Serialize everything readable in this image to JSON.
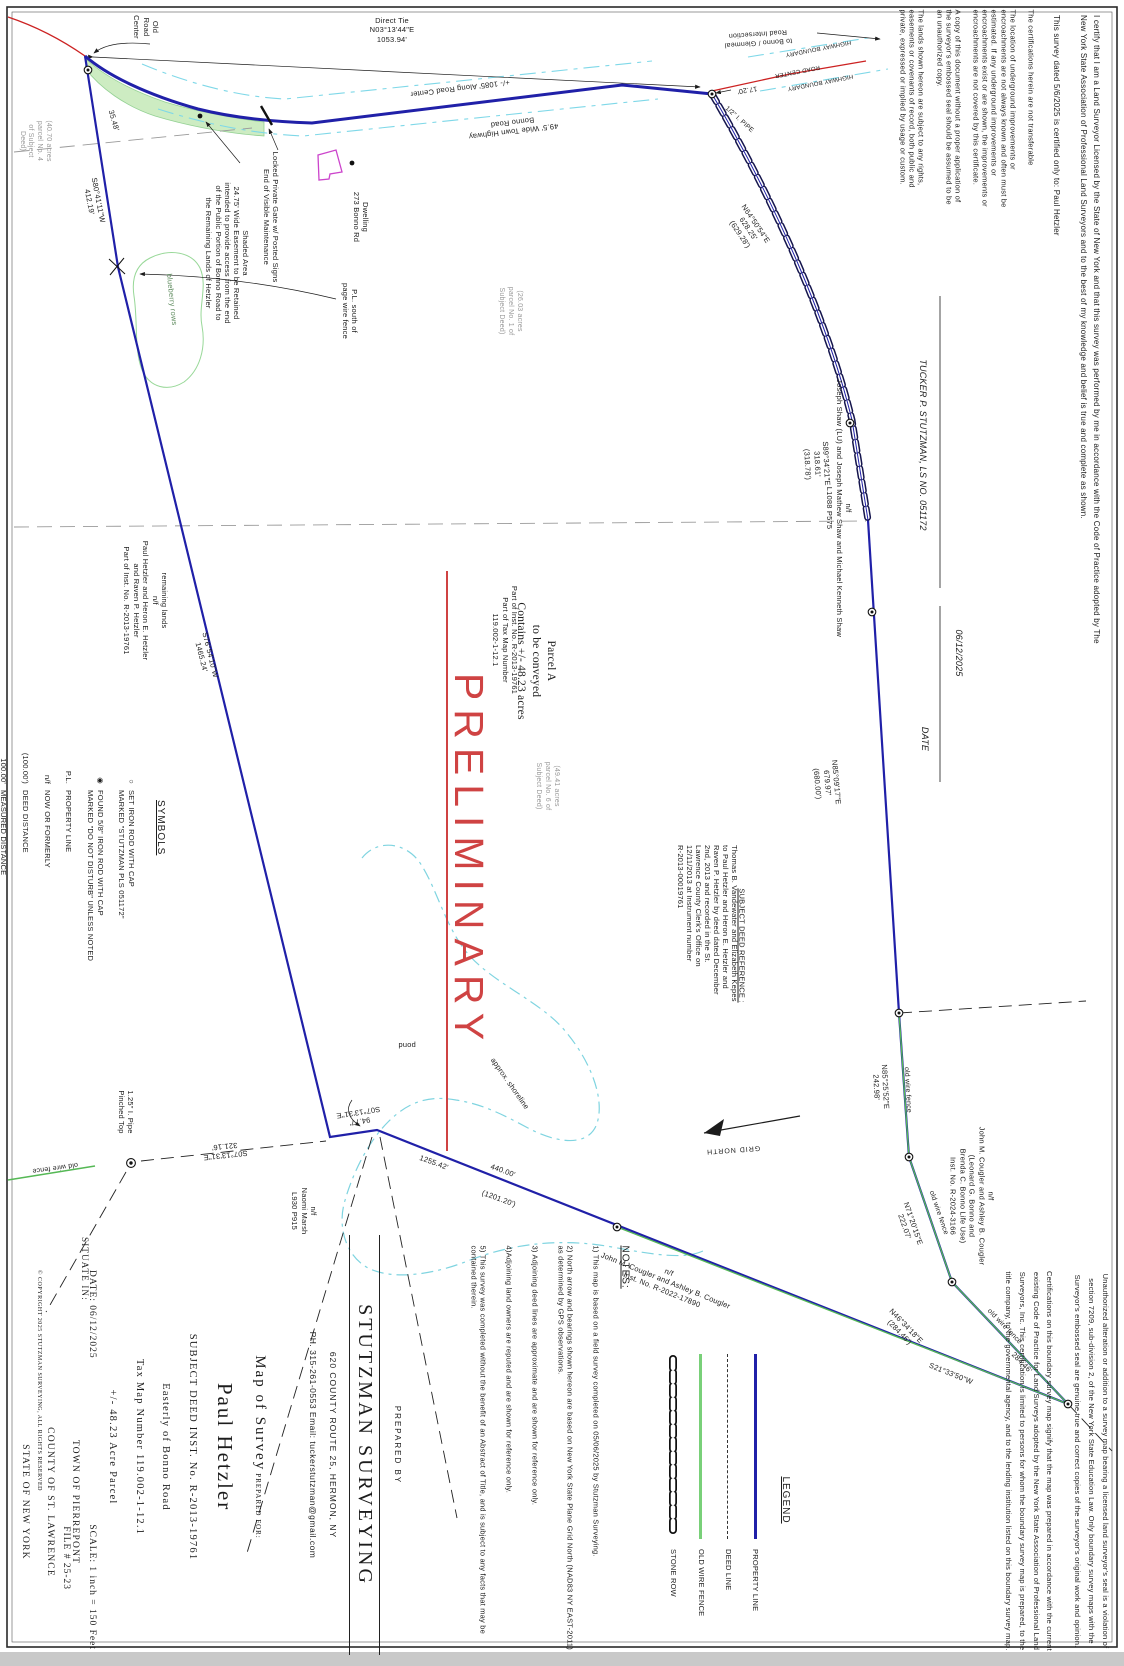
{
  "colors": {
    "property_line": "#2020a8",
    "old_wire_fence": "#55b855",
    "water": "#7fd4e0",
    "road_center": "#cc2222",
    "preliminary": "#cf4343",
    "deed_line": "#333333"
  },
  "road": {
    "old_road_center": "Old\nRoad\nCenter",
    "direct_tie": "Direct Tie\nN03°13'44\"E\n1053.94'",
    "along_center": "+/- 1085' Along Road Center",
    "town_highway": "49.5' Wide Town Highway\nBonno Road",
    "to_intersection": "to Bonno / Glenmeal\nRoad Intersection",
    "hwy_boundary": "HIGHWAY BOUNDARY",
    "road_center": "ROAD CENTER",
    "tie_17_20": "17.20'",
    "pipe_half": "1/2\" I. PIPE",
    "dwelling": "Dwelling\n273 Bonno Rd",
    "locked_gate": "Locked Private Gate w/ Posted Signs\nEnd of Visible Maintenance",
    "shaded_area": "Shaded Area\n24.75' Wide Easement to be Retained\nintended to provide access from the end\nof the Public Portion of Bonno Road to\nthe Remaining Lands of Hetzler"
  },
  "bearings": {
    "n64": "N64°50'54\"E\n628.25'\n(629.28')",
    "s89": "S89°34'21\"E\n318.61'\n(318.78')",
    "n85a": "N85°09'17\"E\n679.97'\n(680.00')",
    "n85b": "N85°25'52\"E\n242.98'",
    "n71": "N71°20'15\"E\n222.07'",
    "n46": "N46°34'18\"E\n(284.46')",
    "n46_meas": "284.46'",
    "s21": "S21°33'50\"W",
    "s80": "S80°41'11\"W\n412.19'",
    "s76": "S76°54'10\"W\n1465.24'",
    "s07_321": "S07°13'31\"E\n321.16'",
    "s07_94": "94.77'\nS07°13'31\"E",
    "d1255": "1255.42'",
    "d440": "440.00'",
    "d1201": "(1201.20')",
    "d35": "35.48'",
    "old_wire_fence": "old wire fence",
    "pipe125": "1.25\" I. Pipe\nPinched Top"
  },
  "owners": {
    "shaw": "n/f\nJoseph Shaw (LU) and Joseph Mathew Shaw and Michael Kenneth Shaw\nL1088 P575",
    "cougler_bonno": "n/f\nJohn M. Cougler and Ashley B. Cougler\n(Leonard G. Bonno and\nBrenda C. Bonno Life Use)\nInst. No. R-2024-3166",
    "cougler": "n/f\nJohn M. Cougler and Ashley B. Cougler\nInst. No. R-2022-17890",
    "naomi": "n/f\nNaomi Marsh\nL930 P915",
    "remaining": "remaining lands\nn/f\nPaul Hetzler and Heron E. Hetzler\nand Raven P. Hetzler\nPart of Inst. No. R-2013-19761"
  },
  "parcel": {
    "a": "Parcel A\nto be conveyed\nContains +/- 48.23 acres",
    "inst": "Part of Inst. No. R-2013-19761\nPart of Tax Map Number\n119.002-1-12.1",
    "p40": "(40.70 acres\nparcel No. 4\nof Subject\nDeed)",
    "p26": "(26.03 acres\nparcel No. 1 of\nSubject Deed)",
    "p49": "(49.41 acres\nparcel No. 6 of\nSubject Deed)",
    "preliminary": "PRELIMINARY",
    "pond": "pond",
    "shoreline": "approx. shoreline",
    "blueberry": "blueberry rows",
    "pl_south": "P.L. south of\npage wire fence",
    "grid_north": "GRID NORTH"
  },
  "deed_ref": {
    "header": "SUBJECT DEED REFERENCE :",
    "body": "Thomas B. Vandewater and Elizabeth Kepes\nto Paul Hetzler and Heron E. Hetzler and\nRaven P. Hetzler by deed dated December\n2nd, 2013 and recorded in the St.\nLawrence County Clerk's Office on\n12/11/2013 at Instrument number\nR-2013-00019761"
  },
  "symbols": {
    "header": "SYMBOLS",
    "items": [
      {
        "glyph": "○",
        "label": "SET IRON ROD WITH CAP\nMARKED \"STUTZMAN PLS 051172\""
      },
      {
        "glyph": "◉",
        "label": "FOUND 5/8\" IRON ROD WITH CAP\nMARKED \"DO NOT DISTURB\" UNLESS NOTED"
      },
      {
        "glyph": "P.L.",
        "label": "PROPERTY LINE"
      },
      {
        "glyph": "n/f",
        "label": "NOW OR FORMERLY"
      },
      {
        "glyph": "(100.00')",
        "label": "DEED DISTANCE"
      },
      {
        "glyph": "100.00'",
        "label": "MEASURED DISTANCE"
      }
    ]
  },
  "legend": {
    "header": "LEGEND",
    "items": [
      {
        "label": "PROPERTY LINE",
        "swatch": "solid",
        "color": "#2020a8"
      },
      {
        "label": "DEED LINE",
        "swatch": "dashed",
        "color": "#333333"
      },
      {
        "label": "OLD WIRE FENCE",
        "swatch": "fence",
        "color": "#79d079"
      },
      {
        "label": "STONE ROW",
        "swatch": "stone",
        "color": "#111111"
      }
    ]
  },
  "notes": {
    "header": "NOTES:",
    "items": [
      "1) This map is based on a field survey completed on 05/06/2025 by Stutzman Surveying.",
      "2) North arrow and bearings shown hereon are based on New York State Plane Grid North (NAD83 NY EAST-2011) as determined by GPS observations.",
      "3) Adjoining deed lines are approximate and are shown for reference only.",
      "4)Adjoining land owners are reputed and are shown for reference only.",
      "5) This survey was completed without the benefit of an Abstract of Title, and is subject to any facts that may be contained therein."
    ]
  },
  "title_block": {
    "map_of": "Map of Survey",
    "prepared_for": "PREPARED FOR:",
    "client": "Paul Hetzler",
    "deed": "SUBJECT DEED INST. No. R-2013-19761",
    "location": "Easterly of Bonno Road",
    "tax": "Tax Map Number 119.002-1-12.1",
    "acreage": "+/- 48.23 Acre Parcel",
    "situate": "SITUATE IN:",
    "town": "TOWN OF PIERREPONT",
    "county": "COUNTY OF ST. LAWRENCE",
    "state": "STATE OF NEW YORK"
  },
  "admin": {
    "date": "DATE: 06/12/2025",
    "scale": "SCALE: 1 inch = 150 Feet",
    "file": "FILE # 25-23",
    "copyright": "© COPYRIGHT 2025 STUTZMAN SURVEYING, ALL RIGHTS RESERVED"
  },
  "prepared_by": {
    "label": "PREPARED BY",
    "firm": "STUTZMAN SURVEYING",
    "address": "620 COUNTY ROUTE 25, HERMON, NY",
    "phone": "PH. 315-261-0553  Email: tuckerstutzman@gmail.com"
  },
  "certification": {
    "certify": "I certify that I am a Land Surveyor Licensed by the State of New York and that this survey was performed by me in accordance with the Code of Practice adopted by The New York State Association of Professional Land Surveyors and to the best of my knowledge and belief is true and complete as shown.",
    "certified_to": "This survey dated 5/6/2025 is certified only to: Paul Hetzler",
    "date": "06/12/2025",
    "date_label": "DATE",
    "surveyor": "TUCKER P. STUTZMAN, LS NO. 051172",
    "disclaimers": "The certifications herein are not transferable\n\nThe location of underground improvements or encroachments are not always known and often must be estimated. If any underground improvements or encroachments exist or are shown, the improvements or encroachments are not covered by this certificate.\n\nA copy of this document without a proper application of the surveyor's embossed seal should be assumed to be an unauthorized copy.\n\nThe lands shown hereon are subject to any rights, easements or covenants of record, both public and private, expressed or implied by usage or custom.",
    "unauthorized": "Unauthorized alteration or addition to a survey map bearing a licensed land surveyor's seal is a violation of section 7209, sub-division 2, of the New York State Education Law. Only boundary survey maps with the Surveyor's embossed seal are genuine true and correct copies of the surveyor's original work and opinion.\n\nCertifications on this boundary survey map signify that the map was prepared in accordance with the current existing Code of Practice for Land Surveys adopted by the New York State Association of Professional Land Surveyors, Inc. This certification is limited to persons for whom the boundary survey map is prepared, to the title company, to the governmental agency, and to the lending institution listed on this boundary survey map."
  }
}
